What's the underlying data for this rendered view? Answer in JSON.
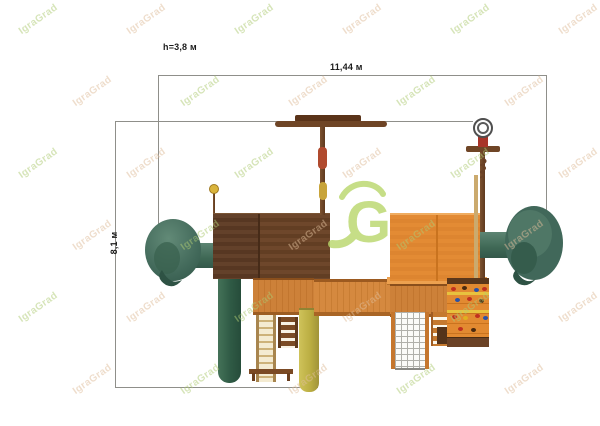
{
  "labels": {
    "height": "h=3,8 м",
    "width": "11,44 м",
    "depth": "8,1 м"
  },
  "watermark": {
    "text": "IgraGrad",
    "logo_letter": "G",
    "green": "#aecb74",
    "tan": "#dfbd9a"
  },
  "colors": {
    "dimension_line": "#8f8f8a",
    "roof_left_brown": "#5e3c24",
    "roof_right_orange": "#e28a33",
    "wood_orange": "#cc8038",
    "slide_green": "#41685a",
    "slide_yellow": "#bfb34a",
    "pole_red_sleeve": "#b04a2e",
    "pole_yellow_sleeve": "#c8a43a",
    "logo_green": "#b9d76a"
  }
}
